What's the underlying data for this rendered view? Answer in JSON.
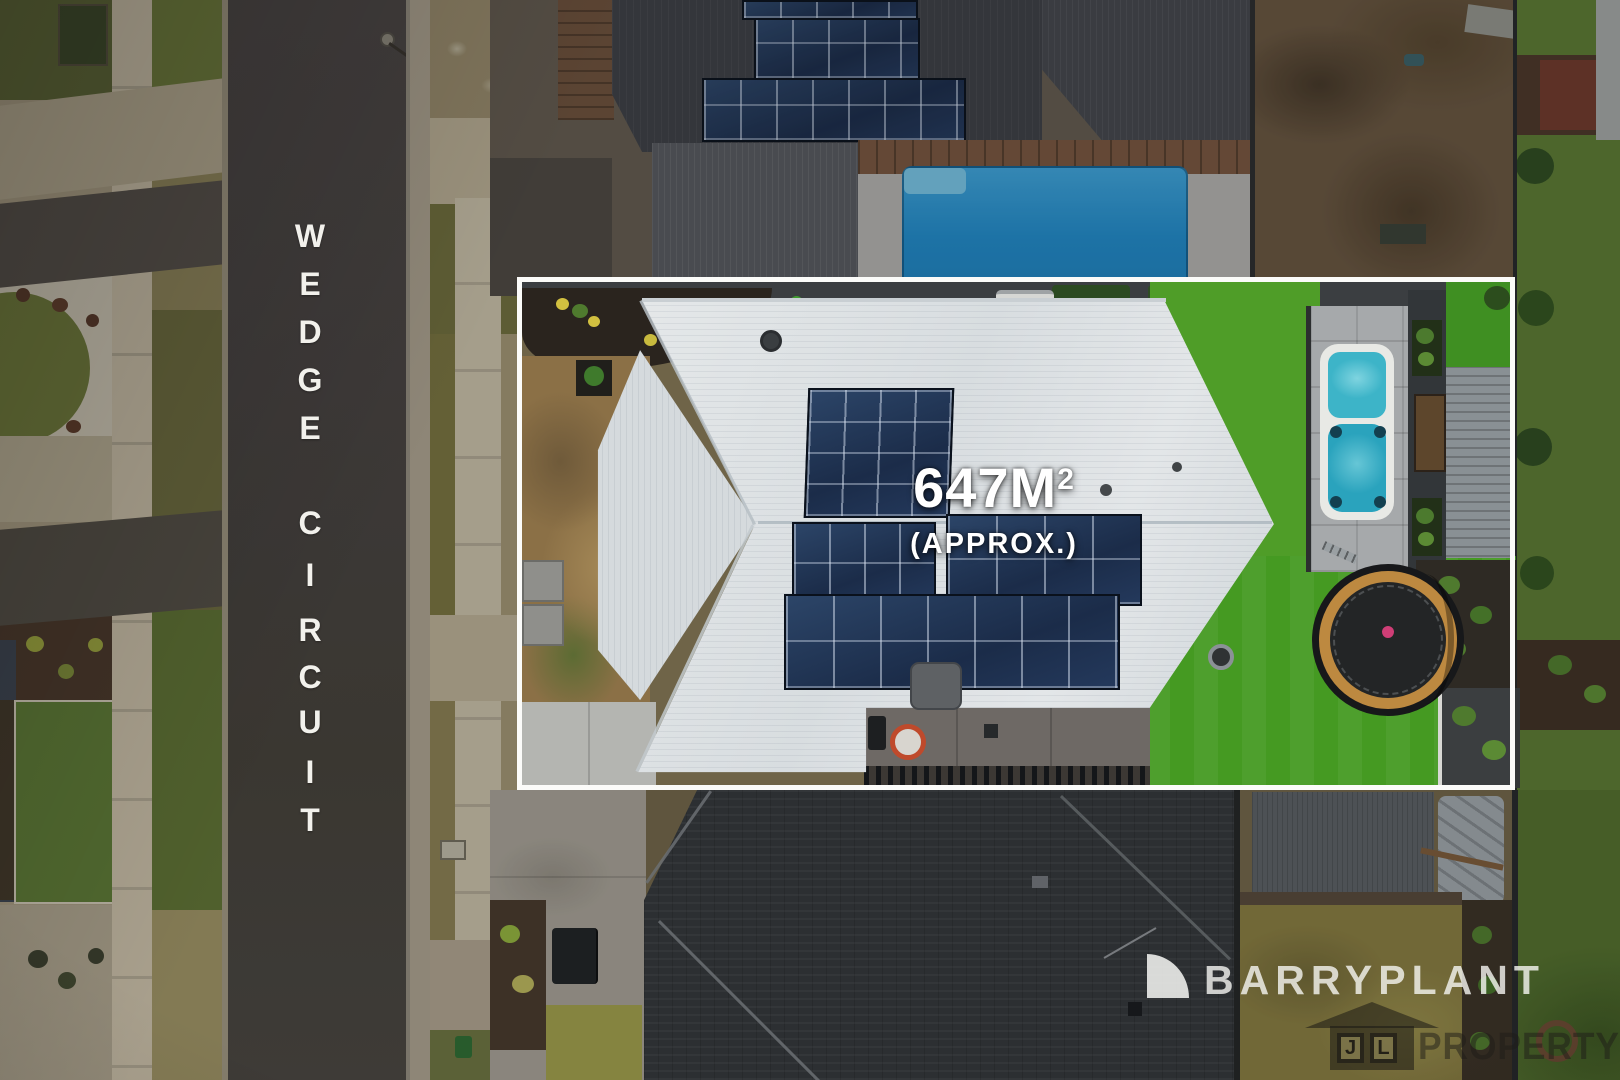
{
  "street_label": {
    "text": "WEDGE CIRCUIT",
    "letters": [
      "W",
      "E",
      "D",
      "G",
      "E",
      "C",
      "I",
      "R",
      "C",
      "U",
      "I",
      "T"
    ]
  },
  "area_overlay": {
    "value": "647M",
    "superscript": "2",
    "qualifier": "(APPROX.)"
  },
  "watermarks": {
    "agency": {
      "name": "BARRYPLANT",
      "icon": "quarter-circle-icon"
    },
    "media": {
      "initial_left": "J",
      "initial_right": "L",
      "wordmark": "PROPERTY",
      "icon": "house-icon"
    }
  },
  "colors": {
    "boundary_outline": "#fbfbf9",
    "road_asphalt": "#474241",
    "street_text": "#f2f1ec",
    "featured_roof": "#dfe2e4",
    "neighbor_roof_dark": "#34373b",
    "solar_panel": "#22314b",
    "pool_blue": "#2187c4",
    "swim_spa_teal": "#38afc4",
    "lawn_green": "#459a22",
    "trampoline_ring": "#bd8940",
    "target_marker_red": "#bf4a2c"
  }
}
